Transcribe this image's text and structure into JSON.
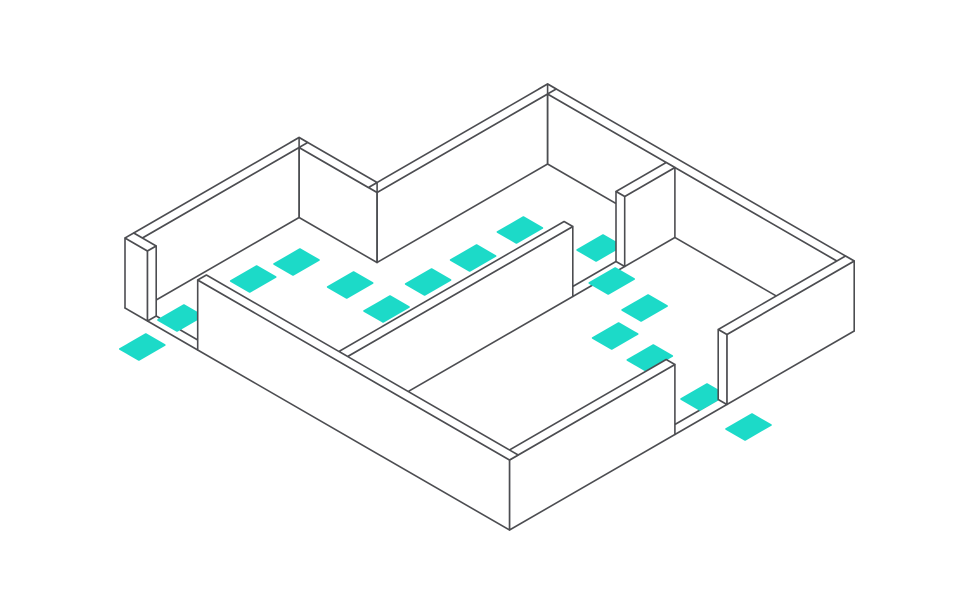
{
  "canvas": {
    "width": 980,
    "height": 600,
    "background": "#ffffff"
  },
  "colors": {
    "line": "#4c4d51",
    "wall_fill": "#ffffff",
    "marker": "#1cdac8"
  },
  "style": {
    "stroke_width": 1.6
  },
  "diagram": {
    "kind": "isometric-floorplan-with-footpath",
    "rooms": 2,
    "door_openings": 3,
    "iso": {
      "origin": [
        125,
        308
      ],
      "axis_a": [
        0.866,
        0.5
      ],
      "axis_b": [
        0.866,
        -0.5
      ],
      "wall_height": 70,
      "wall_thickness": 10
    },
    "markers": {
      "name": "footprint-marker",
      "count": 16,
      "half_a": 11,
      "half_b": 15,
      "cells": [
        [
          49,
          -29
        ],
        [
          42,
          22
        ],
        [
          45,
          103
        ],
        [
          53,
          145
        ],
        [
          107,
          153
        ],
        [
          152,
          150
        ],
        [
          149,
          201
        ],
        [
          151,
          251
        ],
        [
          150,
          306
        ],
        [
          214,
          334
        ],
        [
          254,
          308
        ],
        [
          300,
          300
        ],
        [
          311,
          255
        ],
        [
          353,
          253
        ],
        [
          423,
          245
        ],
        [
          479,
          241
        ]
      ]
    },
    "shapes": [
      {
        "name": "ground-outline",
        "kind": "polyline",
        "points": [
          [
            125,
            308
          ],
          [
            299.1,
            207.5
          ],
          [
            377.1,
            252.5
          ],
          [
            547.6,
            154
          ],
          [
            854.2,
            331
          ]
        ]
      },
      {
        "name": "west-door-threshold-outer",
        "kind": "polyline",
        "points": [
          [
            147.5,
            321
          ],
          [
            197.7,
            350
          ]
        ]
      },
      {
        "name": "west-door-threshold-inner",
        "kind": "polyline",
        "points": [
          [
            156.2,
            316
          ],
          [
            206.4,
            345
          ]
        ]
      },
      {
        "name": "divider-door-threshold-outer",
        "kind": "polyline",
        "points": [
          [
            572.8,
            296.5
          ],
          [
            624.7,
            266.5
          ]
        ]
      },
      {
        "name": "divider-door-threshold-inner",
        "kind": "polyline",
        "points": [
          [
            564.1,
            291.5
          ],
          [
            616,
            261.5
          ]
        ]
      },
      {
        "name": "se-door-threshold-outer",
        "kind": "polyline",
        "points": [
          [
            674.9,
            434.5
          ],
          [
            726.9,
            404.5
          ]
        ]
      },
      {
        "name": "se-door-threshold-inner",
        "kind": "polyline",
        "points": [
          [
            666.2,
            429.5
          ],
          [
            718.2,
            399.5
          ]
        ]
      },
      {
        "kind": "markers"
      },
      {
        "name": "wall-north-face",
        "kind": "wall",
        "points": [
          [
            547.6,
            94
          ],
          [
            836.9,
            261
          ],
          [
            836.9,
            331
          ],
          [
            547.6,
            164
          ]
        ]
      },
      {
        "name": "wall-north-top",
        "kind": "wall",
        "points": [
          [
            547.6,
            84
          ],
          [
            854.2,
            261
          ],
          [
            845.6,
            266
          ],
          [
            538.9,
            89
          ]
        ]
      },
      {
        "name": "wall-notch-east-face",
        "kind": "wall",
        "points": [
          [
            377,
            192.5
          ],
          [
            547.6,
            94
          ],
          [
            547.6,
            164
          ],
          [
            377,
            262.5
          ]
        ]
      },
      {
        "name": "wall-notch-east-top",
        "kind": "wall",
        "points": [
          [
            368.4,
            187.5
          ],
          [
            547.6,
            84
          ],
          [
            556.2,
            89
          ],
          [
            377,
            192.5
          ]
        ]
      },
      {
        "name": "wall-notch-south-face",
        "kind": "wall",
        "points": [
          [
            299.1,
            147.5
          ],
          [
            377,
            192.5
          ],
          [
            377,
            262.5
          ],
          [
            299.1,
            217.5
          ]
        ]
      },
      {
        "name": "wall-notch-south-top",
        "kind": "wall",
        "points": [
          [
            299.1,
            137.5
          ],
          [
            377.1,
            182.5
          ],
          [
            368.4,
            187.5
          ],
          [
            290.4,
            142.5
          ]
        ]
      },
      {
        "name": "wall-back-left-face",
        "kind": "wall",
        "points": [
          [
            142.3,
            238
          ],
          [
            299.1,
            147.5
          ],
          [
            299.1,
            217.5
          ],
          [
            142.3,
            308
          ]
        ]
      },
      {
        "name": "wall-back-left-top",
        "kind": "wall",
        "points": [
          [
            133.7,
            233
          ],
          [
            299.1,
            137.5
          ],
          [
            307.7,
            142.5
          ],
          [
            142.3,
            238
          ]
        ]
      },
      {
        "name": "corner-edge-peak",
        "kind": "polyline",
        "points": [
          [
            299.1,
            137.5
          ],
          [
            299.1,
            217.5
          ]
        ]
      },
      {
        "name": "corner-edge-valley",
        "kind": "polyline",
        "points": [
          [
            377.1,
            182.5
          ],
          [
            377.1,
            262.5
          ]
        ]
      },
      {
        "name": "corner-edge-northeast",
        "kind": "polyline",
        "points": [
          [
            547.6,
            84
          ],
          [
            547.6,
            164
          ]
        ]
      },
      {
        "name": "divider-south-face",
        "kind": "wall",
        "points": [
          [
            347.6,
            356.5
          ],
          [
            572.8,
            226.5
          ],
          [
            572.8,
            296.5
          ],
          [
            347.6,
            426.5
          ]
        ]
      },
      {
        "name": "divider-south-top",
        "kind": "wall",
        "points": [
          [
            338.9,
            351.5
          ],
          [
            564.1,
            221.5
          ],
          [
            572.8,
            226.5
          ],
          [
            347.6,
            356.5
          ]
        ]
      },
      {
        "name": "divider-north-face",
        "kind": "wall",
        "points": [
          [
            624.7,
            196.5
          ],
          [
            674.9,
            167.5
          ],
          [
            674.9,
            237.5
          ],
          [
            624.7,
            266.5
          ]
        ]
      },
      {
        "name": "divider-north-top",
        "kind": "wall",
        "points": [
          [
            616,
            191.5
          ],
          [
            666.2,
            162.5
          ],
          [
            674.9,
            167.5
          ],
          [
            624.7,
            196.5
          ]
        ]
      },
      {
        "name": "divider-door-jamb",
        "kind": "wall",
        "points": [
          [
            616,
            191.5
          ],
          [
            624.7,
            196.5
          ],
          [
            624.7,
            266.5
          ],
          [
            616,
            261.5
          ]
        ]
      },
      {
        "name": "wall-front-right-east-face",
        "kind": "wall",
        "points": [
          [
            726.9,
            334.5
          ],
          [
            854.2,
            261
          ],
          [
            854.2,
            331
          ],
          [
            726.9,
            404.5
          ]
        ]
      },
      {
        "name": "wall-front-right-east-top",
        "kind": "wall",
        "points": [
          [
            718.2,
            329.5
          ],
          [
            845.5,
            256
          ],
          [
            854.2,
            261
          ],
          [
            726.9,
            334.5
          ]
        ]
      },
      {
        "name": "se-door-jamb",
        "kind": "wall",
        "points": [
          [
            718.2,
            329.5
          ],
          [
            726.9,
            334.5
          ],
          [
            726.9,
            404.5
          ],
          [
            718.2,
            399.5
          ]
        ]
      },
      {
        "name": "wall-front-right-south-face",
        "kind": "wall",
        "points": [
          [
            509.5,
            460
          ],
          [
            674.9,
            364.5
          ],
          [
            674.9,
            434.5
          ],
          [
            509.5,
            530
          ]
        ]
      },
      {
        "name": "wall-front-right-south-top",
        "kind": "wall",
        "points": [
          [
            500.8,
            455
          ],
          [
            666.2,
            359.5
          ],
          [
            674.9,
            364.5
          ],
          [
            509.5,
            460
          ]
        ]
      },
      {
        "name": "wall-front-left-stub-face",
        "kind": "wall",
        "points": [
          [
            125,
            238
          ],
          [
            147.5,
            251
          ],
          [
            147.5,
            321
          ],
          [
            125,
            308
          ]
        ]
      },
      {
        "name": "wall-front-left-stub-top",
        "kind": "wall",
        "points": [
          [
            125,
            238
          ],
          [
            147.5,
            251
          ],
          [
            156.2,
            246
          ],
          [
            133.7,
            233
          ]
        ]
      },
      {
        "name": "west-door-jamb",
        "kind": "wall",
        "points": [
          [
            147.5,
            251
          ],
          [
            156.2,
            246
          ],
          [
            156.2,
            316
          ],
          [
            147.5,
            321
          ]
        ]
      },
      {
        "name": "wall-front-left-face",
        "kind": "wall",
        "points": [
          [
            197.7,
            280
          ],
          [
            509.5,
            460
          ],
          [
            509.5,
            530
          ],
          [
            197.7,
            350
          ]
        ]
      },
      {
        "name": "wall-front-left-top",
        "kind": "wall",
        "points": [
          [
            197.7,
            280
          ],
          [
            509.5,
            460
          ],
          [
            518.2,
            455
          ],
          [
            206.4,
            275
          ]
        ]
      }
    ]
  }
}
